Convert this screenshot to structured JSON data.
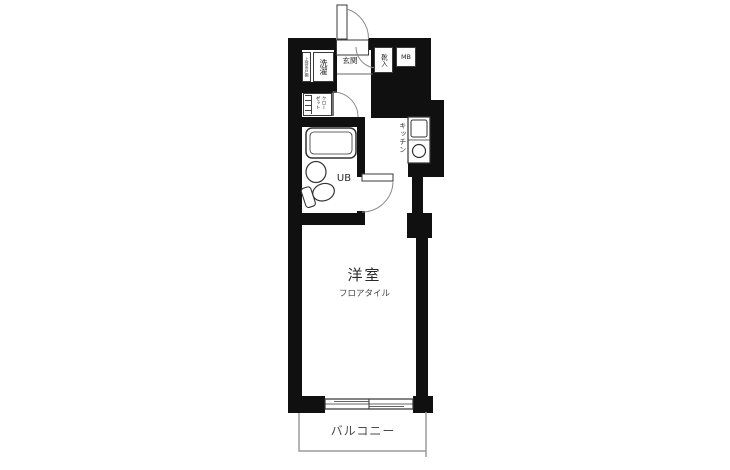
{
  "plan": {
    "title": "apartment-floor-plan",
    "rooms": {
      "entrance": "玄関",
      "laundry": "洗濯",
      "laundry_shelf": "上部吊戸棚",
      "shoe_box": "靴入",
      "meter_box": "MB",
      "closet": "クローゼット",
      "unit_bath": "UB",
      "kitchen": "キッチン",
      "main_room": "洋室",
      "main_room_floor": "フロアタイル",
      "balcony": "バルコニー"
    },
    "fixtures": [
      "bathtub",
      "washbasin",
      "toilet",
      "kitchen-sink",
      "stove-burner",
      "entrance-door",
      "bath-door",
      "closet-door",
      "sliding-window"
    ],
    "colors": {
      "wall": "#101010",
      "line": "#333333",
      "swing_line": "#8a8a8a",
      "balcony_line": "#9b9b9b",
      "background": "#ffffff"
    }
  }
}
